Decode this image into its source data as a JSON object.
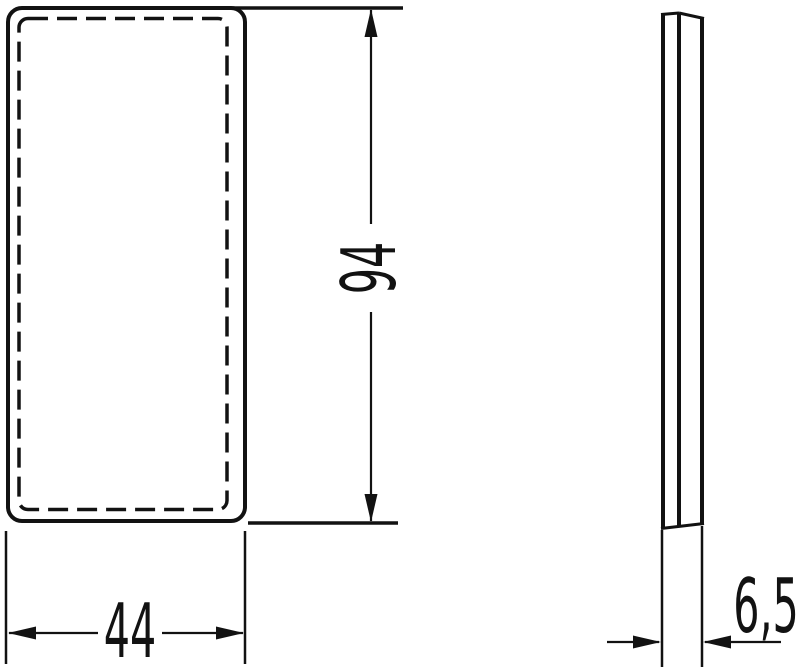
{
  "colors": {
    "background": "#ffffff",
    "ink": "#121212"
  },
  "dimensions": {
    "width_mm": "44",
    "height_mm": "94",
    "depth_mm": "6,5"
  }
}
